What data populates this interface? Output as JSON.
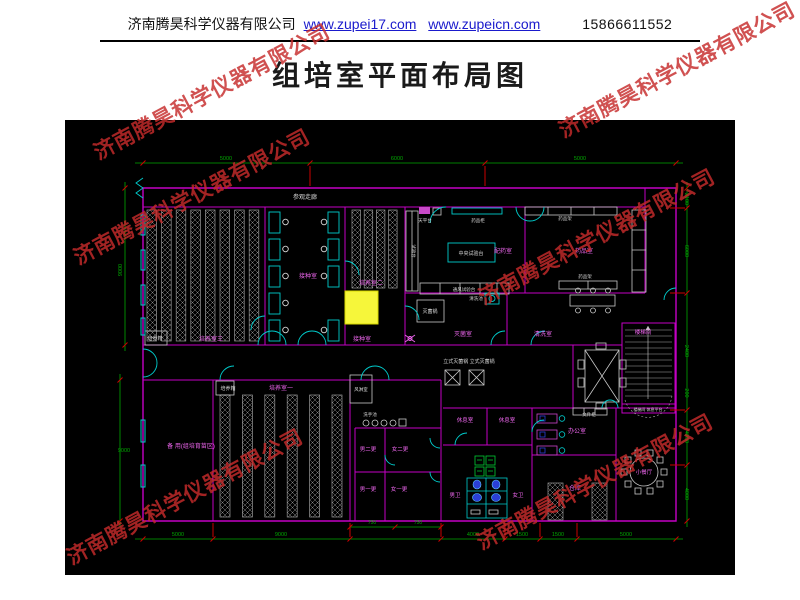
{
  "header": {
    "company": "济南腾昊科学仪器有限公司",
    "url1": "www.zupei17.com",
    "url2": "www.zupeicn.com",
    "phone": "15866611552"
  },
  "title": "组培室平面布局图",
  "watermark": {
    "text": "济南腾昊科学仪器有限公司",
    "color": "#c62b2b"
  },
  "plan": {
    "background": "#000000",
    "colors": {
      "wall": "#c400c4",
      "door": "#00cccc",
      "dim": "#00a800",
      "tick": "#cc0000",
      "room_label": "#ee66ee",
      "fixture_label": "#d8d8d8",
      "fixture": "#c9c9c9",
      "rack": "#9a9a9a",
      "highlight": "#f6f63a",
      "stall": "#00cc33",
      "sanitary": "#2b3fd6"
    },
    "room_labels": [
      {
        "t": "参观走廊",
        "x": 240,
        "y": 79,
        "c": "w"
      },
      {
        "t": "培养箱",
        "x": 90,
        "y": 220,
        "c": "w",
        "s": 5
      },
      {
        "t": "培养室三",
        "x": 146,
        "y": 221,
        "c": "m"
      },
      {
        "t": "接种室",
        "x": 243,
        "y": 158,
        "c": "m"
      },
      {
        "t": "培养室二",
        "x": 306,
        "y": 165,
        "c": "m"
      },
      {
        "t": "接种室",
        "x": 297,
        "y": 221,
        "c": "m"
      },
      {
        "t": "天平台",
        "x": 360,
        "y": 102,
        "c": "w",
        "s": 4.5
      },
      {
        "t": "药品柜",
        "x": 413,
        "y": 102,
        "c": "w",
        "s": 4.5
      },
      {
        "t": "中央试验台",
        "x": 406,
        "y": 135,
        "c": "w",
        "s": 5
      },
      {
        "t": "配药室",
        "x": 438,
        "y": 133,
        "c": "m"
      },
      {
        "t": "药品架",
        "x": 500,
        "y": 100,
        "c": "w",
        "s": 4.5
      },
      {
        "t": "药品室",
        "x": 519,
        "y": 133,
        "c": "m"
      },
      {
        "t": "药品架",
        "x": 520,
        "y": 158,
        "c": "w",
        "s": 4.5
      },
      {
        "t": "试验台",
        "x": 347,
        "y": 131,
        "c": "w",
        "v": true,
        "s": 4.5
      },
      {
        "t": "通风试验台",
        "x": 399,
        "y": 171,
        "c": "w",
        "s": 4.5
      },
      {
        "t": "灭菌锅",
        "x": 365,
        "y": 193,
        "c": "w",
        "s": 5
      },
      {
        "t": "灭菌室",
        "x": 398,
        "y": 216,
        "c": "m"
      },
      {
        "t": "清洗池",
        "x": 411,
        "y": 180,
        "c": "w",
        "s": 4.5
      },
      {
        "t": "清洗室",
        "x": 478,
        "y": 216,
        "c": "m"
      },
      {
        "t": "立式灭菌锅 立式灭菌锅",
        "x": 404,
        "y": 243,
        "c": "w",
        "s": 5
      },
      {
        "t": "楼梯间",
        "x": 578,
        "y": 214,
        "c": "m",
        "s": 5.5
      },
      {
        "t": "楼梯间 休息平台",
        "x": 583,
        "y": 291,
        "c": "w",
        "s": 4
      },
      {
        "t": "备 用(组培育苗区)",
        "x": 126,
        "y": 328,
        "c": "m"
      },
      {
        "t": "培养箱",
        "x": 163,
        "y": 270,
        "c": "w",
        "s": 5
      },
      {
        "t": "培养室一",
        "x": 216,
        "y": 270,
        "c": "m"
      },
      {
        "t": "风淋室",
        "x": 296,
        "y": 271,
        "c": "w",
        "s": 4.5
      },
      {
        "t": "洗手池",
        "x": 305,
        "y": 296,
        "c": "w",
        "s": 4.5
      },
      {
        "t": "男二更",
        "x": 303,
        "y": 331,
        "c": "m",
        "s": 5.5
      },
      {
        "t": "女二更",
        "x": 335,
        "y": 331,
        "c": "m",
        "s": 5.5
      },
      {
        "t": "男一更",
        "x": 303,
        "y": 371,
        "c": "m",
        "s": 5.5
      },
      {
        "t": "女一更",
        "x": 334,
        "y": 371,
        "c": "m",
        "s": 5.5
      },
      {
        "t": "休息室",
        "x": 400,
        "y": 302,
        "c": "m",
        "s": 5.5
      },
      {
        "t": "休息室",
        "x": 442,
        "y": 302,
        "c": "m",
        "s": 5.5
      },
      {
        "t": "男卫",
        "x": 390,
        "y": 377,
        "c": "m",
        "s": 5.5
      },
      {
        "t": "女卫",
        "x": 453,
        "y": 377,
        "c": "m",
        "s": 5.5
      },
      {
        "t": "文件柜",
        "x": 524,
        "y": 296,
        "c": "w",
        "s": 4.5
      },
      {
        "t": "办公室",
        "x": 512,
        "y": 313,
        "c": "m"
      },
      {
        "t": "仓库",
        "x": 510,
        "y": 370,
        "c": "m"
      },
      {
        "t": "小餐厅",
        "x": 579,
        "y": 354,
        "c": "m",
        "s": 5.5
      }
    ],
    "dimensions": {
      "top": [
        {
          "t": "5000",
          "x": 161
        },
        {
          "t": "6000",
          "x": 332
        },
        {
          "t": "5000",
          "x": 515
        }
      ],
      "bottom": [
        {
          "t": "5000",
          "x": 113
        },
        {
          "t": "9000",
          "x": 216
        },
        {
          "t": "4000",
          "x": 408
        },
        {
          "t": "1500",
          "x": 457
        },
        {
          "t": "1500",
          "x": 493
        },
        {
          "t": "5000",
          "x": 561
        }
      ],
      "bottom_sub": [
        {
          "t": "750",
          "x": 307
        },
        {
          "t": "750",
          "x": 353
        }
      ],
      "left": [
        {
          "t": "9000",
          "x": 57,
          "y": 150,
          "rot": true
        },
        {
          "t": "9000",
          "x": 59,
          "y": 332
        }
      ],
      "right": [
        {
          "t": "2100",
          "y": 79
        },
        {
          "t": "6000",
          "y": 131
        },
        {
          "t": "2400",
          "y": 231
        },
        {
          "t": "200",
          "y": 273
        },
        {
          "t": "4000",
          "y": 317
        },
        {
          "t": "4000",
          "y": 374
        }
      ]
    }
  }
}
